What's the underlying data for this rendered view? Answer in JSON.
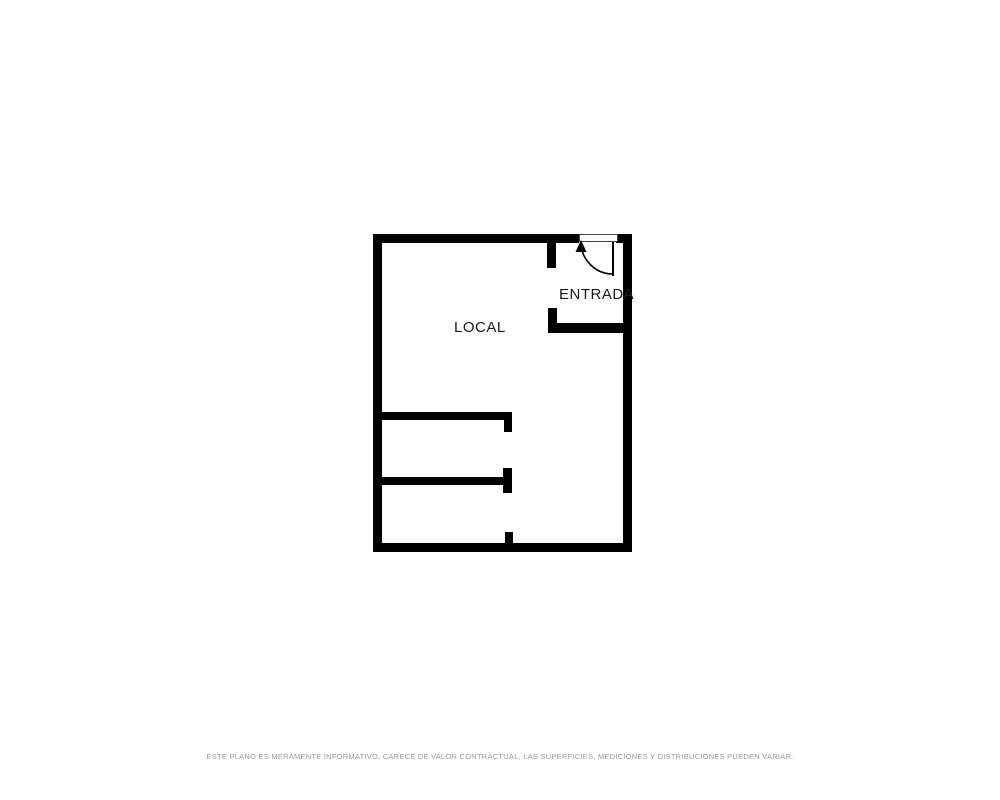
{
  "floorplan": {
    "rooms": [
      {
        "id": "local",
        "label": "LOCAL"
      },
      {
        "id": "entrada",
        "label": "ENTRADA"
      }
    ],
    "door": {
      "type": "swing-door",
      "location": "top-right-entrance"
    }
  },
  "footer": {
    "disclaimer": "ESTE PLANO ES MERAMENTE INFORMATIVO, CARECE DE VALOR CONTRACTUAL, LAS SUPERFICIES, MEDICIONES Y DISTRIBUCIONES PUEDEN VARIAR."
  },
  "colors": {
    "wall": "#000000",
    "background": "#ffffff",
    "label-text": "#1a1a1a",
    "disclaimer-text": "#9a9a9a"
  }
}
